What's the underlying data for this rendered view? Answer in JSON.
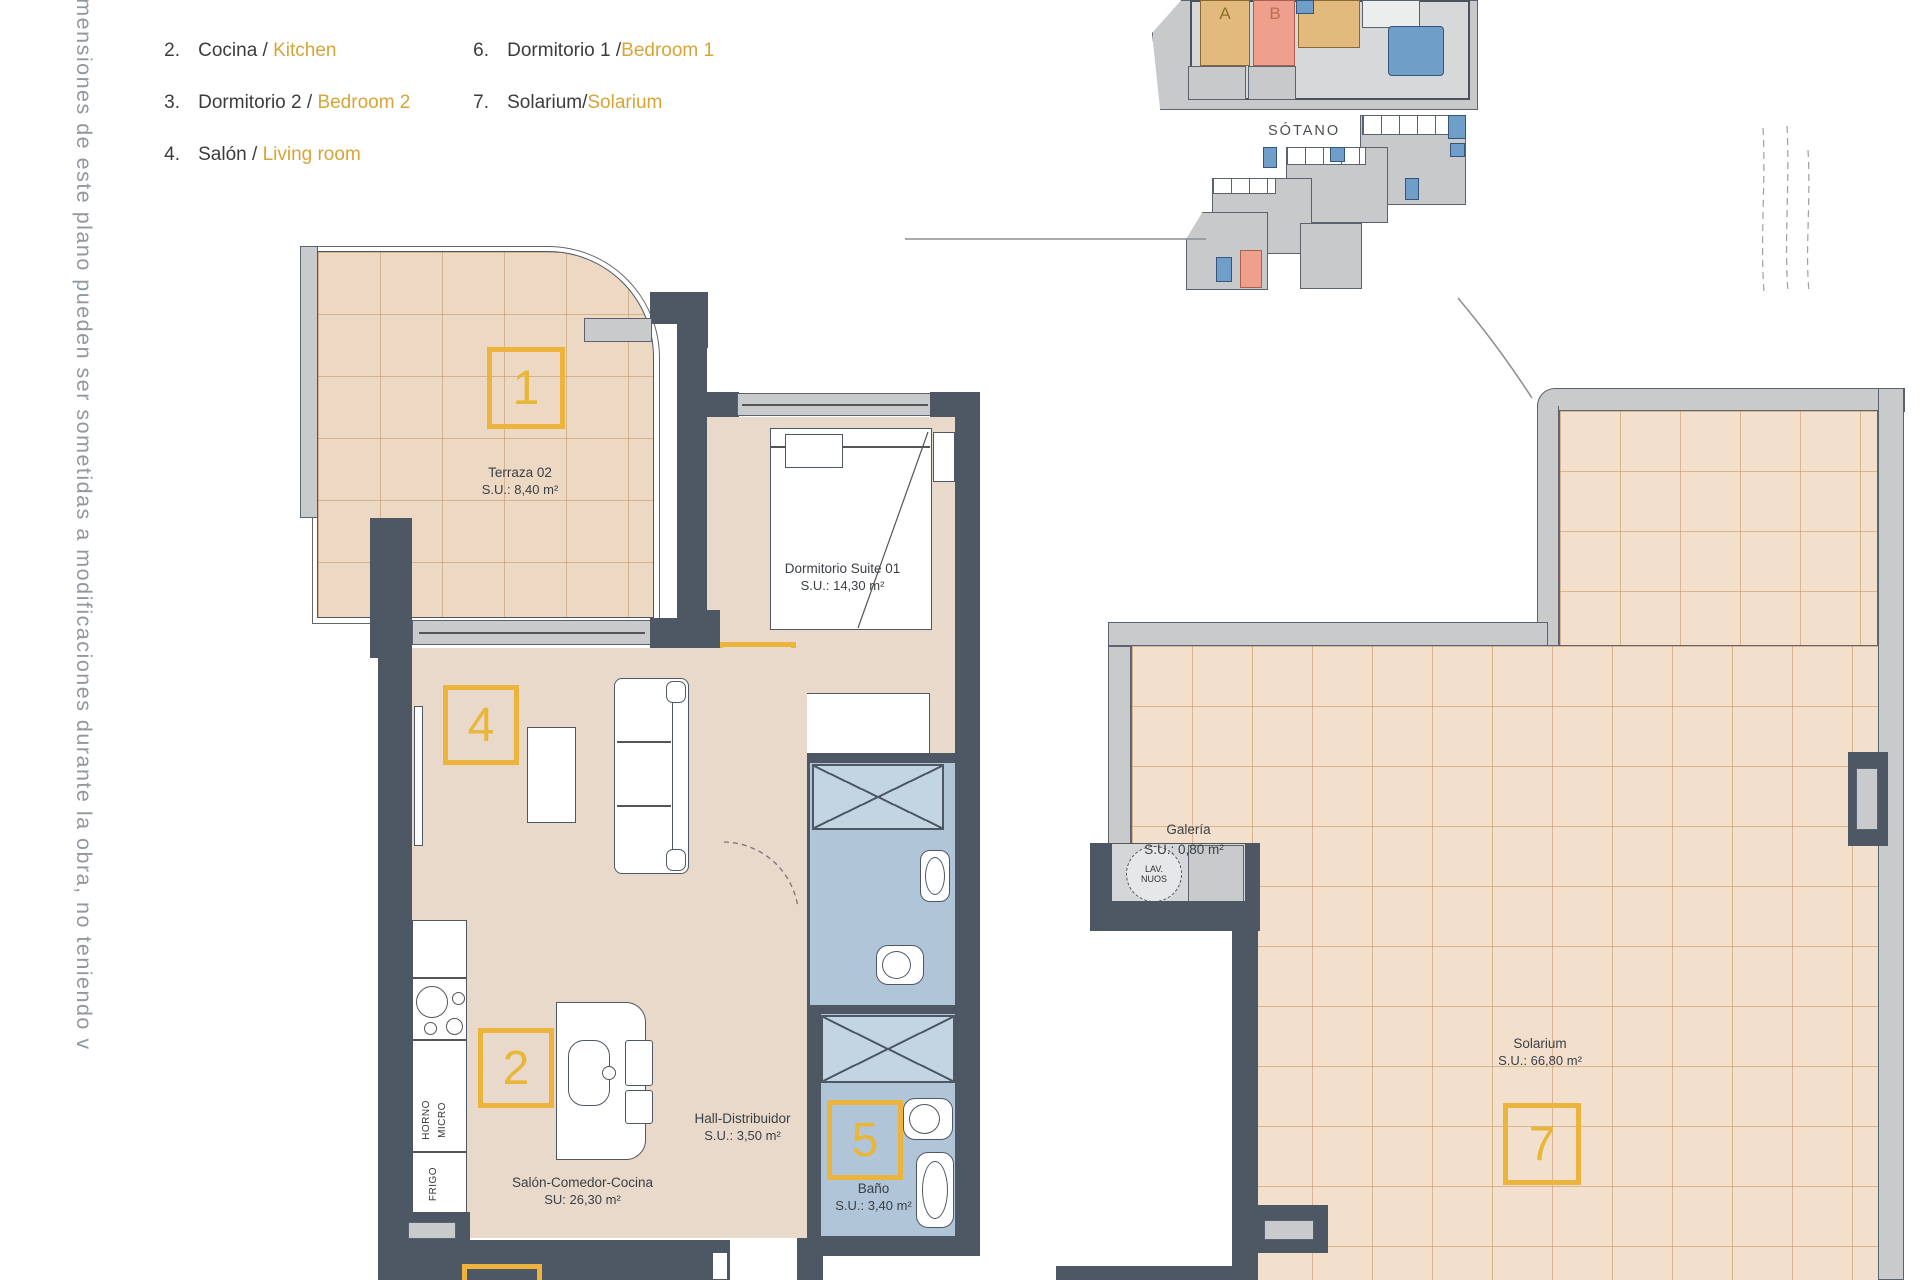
{
  "side_note": "imensiones de este plano pueden ser sometidas a modificaciones durante la obra, no teniendo v",
  "legend": {
    "col1": [
      {
        "num": "2.",
        "es": "Cocina / ",
        "en": "Kitchen"
      },
      {
        "num": "3.",
        "es": "Dormitorio 2 / ",
        "en": "Bedroom 2"
      },
      {
        "num": "4.",
        "es": "Salón / ",
        "en": "Living room"
      }
    ],
    "col2": [
      {
        "num": "6.",
        "es": "Dormitorio 1 /",
        "en": "Bedroom 1"
      },
      {
        "num": "7.",
        "es": "Solarium/",
        "en": "Solarium"
      }
    ]
  },
  "overview": {
    "unit_a": "A",
    "unit_b": "B",
    "basement_title": "SÓTANO"
  },
  "rooms": {
    "terraza": {
      "name": "Terraza 02",
      "area": "S.U.: 8,40 m²"
    },
    "dormitorio": {
      "name": "Dormitorio Suite 01",
      "area": "S.U.: 14,30 m²"
    },
    "hall": {
      "name": "Hall-Distribuidor",
      "area": "S.U.: 3,50 m²"
    },
    "bano": {
      "name": "Baño",
      "area": "S.U.: 3,40 m²"
    },
    "salon": {
      "name": "Salón-Comedor-Cocina",
      "area": "SU: 26,30 m²"
    },
    "galeria": {
      "name": "Galería",
      "area": "S.U.: 0,80 m²"
    },
    "solarium": {
      "name": "Solarium",
      "area": "S.U.: 66,80 m²"
    }
  },
  "markers": {
    "terraza": "1",
    "cocina": "2",
    "salon": "4",
    "bano": "5",
    "dormitorio1": "6",
    "solarium": "7"
  },
  "appliances": {
    "horno": "HORNO",
    "micro": "MICRO",
    "frigo": "FRIGO",
    "lavadero_line1": "LAV.",
    "lavadero_line2": "NUOS"
  },
  "colors": {
    "marker_yellow": "#ecb43c",
    "legend_gold": "#d7a437",
    "wall_dark": "#4e5865",
    "floor_tan": "#e9d9ca",
    "terrace_tile": "#ecd8c3",
    "solarium_tile": "#f2e0cd",
    "bath_blue": "#b0c5d8",
    "highlight_salmon": "#efa08d",
    "overview_tan": "#e2ba7e",
    "overview_blue": "#6f9ec9",
    "light_gray": "#c8cacc"
  }
}
